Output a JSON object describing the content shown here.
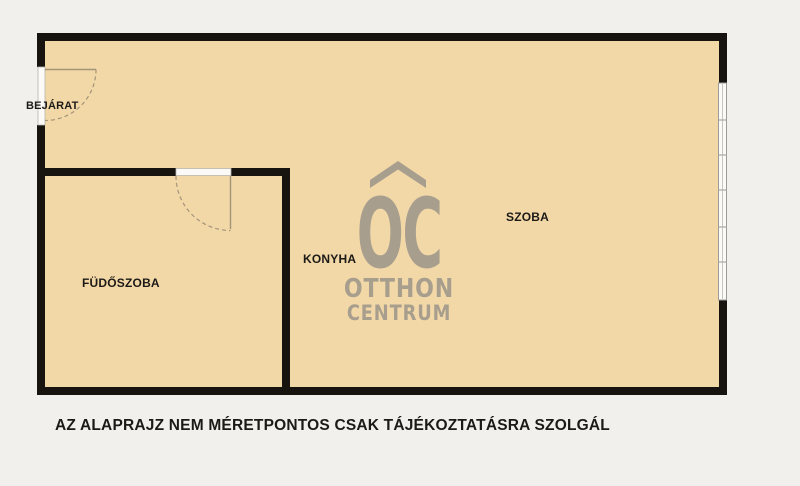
{
  "colors": {
    "bg": "#f1f0ec",
    "floor": "#f3d8a7",
    "wall": "#17130f",
    "door": "#a3947a",
    "threshold": "#fbfaf6",
    "window_frame": "#9b9b98",
    "watermark": "#a89e8e",
    "label": "#1c1a17"
  },
  "rooms": {
    "entrance": {
      "label": "BEJÁRAT"
    },
    "bathroom": {
      "label": "FÜDŐSZOBA"
    },
    "kitchen": {
      "label": "KONYHA"
    },
    "living": {
      "label": "SZOBA"
    }
  },
  "watermark": {
    "monogram": "OC",
    "line1": "OTTHON",
    "line2": "CENTRUM"
  },
  "footer": {
    "disclaimer": "AZ ALAPRAJZ NEM MÉRETPONTOS CSAK TÁJÉKOZTATÁSRA SZOLGÁL"
  }
}
